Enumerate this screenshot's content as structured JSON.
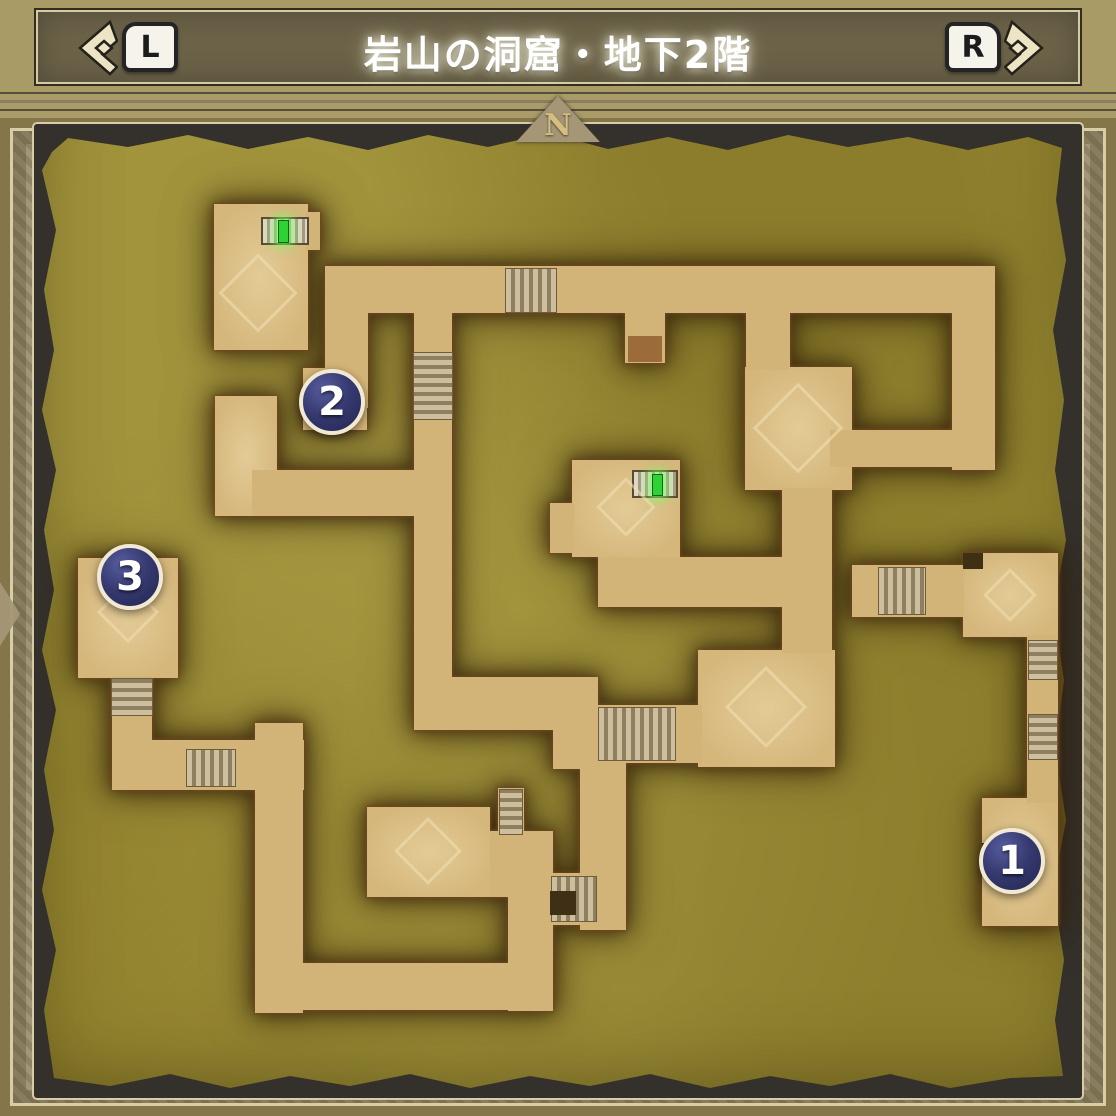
{
  "header": {
    "title": "岩山の洞窟・地下2階",
    "left_button_label": "L",
    "right_button_label": "R",
    "left_chevron_icon": "double-chevron-left-icon",
    "right_chevron_icon": "double-chevron-right-icon"
  },
  "compass": {
    "north_label": "N"
  },
  "map": {
    "name": "岩山の洞窟・地下2階",
    "markers": [
      {
        "number": "1"
      },
      {
        "number": "2"
      },
      {
        "number": "3"
      }
    ],
    "door_markers": [
      {
        "icon": "green-door-icon",
        "location": "northwest-room"
      },
      {
        "icon": "green-door-icon",
        "location": "center-room"
      }
    ],
    "colors": {
      "ground_olive": "#968932",
      "corridor_tan": "#d3b478",
      "corridor_outline": "#6b4820",
      "marker_navy": "#2c3064",
      "marker_ring": "#f1e9d4",
      "door_green": "#2fd235",
      "panel_dark": "#34302b",
      "frame_gold": "#84764a"
    }
  }
}
